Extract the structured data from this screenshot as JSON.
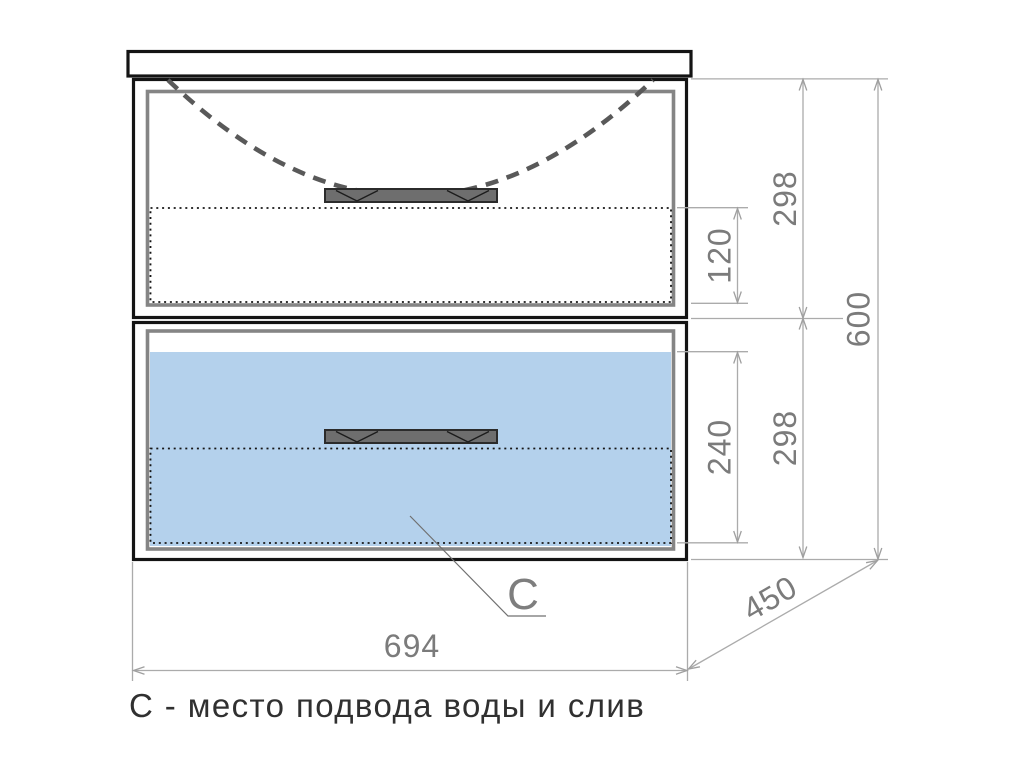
{
  "drawing": {
    "caption": "С - место подвода воды и слив",
    "leader": {
      "label": "C"
    },
    "dims": {
      "top_drawer_height": "298",
      "top_drawer_inset": "120",
      "bottom_drawer_height": "298",
      "bottom_drawer_inset": "240",
      "overall_height": "600",
      "overall_width": "694",
      "overall_depth": "450"
    },
    "colors": {
      "drawer_highlight": "#B4D1EC",
      "dimension_line": "#ABABAB",
      "dimension_text": "#7B7B7B",
      "outline": "#141414",
      "panel_frame": "#858585"
    }
  }
}
